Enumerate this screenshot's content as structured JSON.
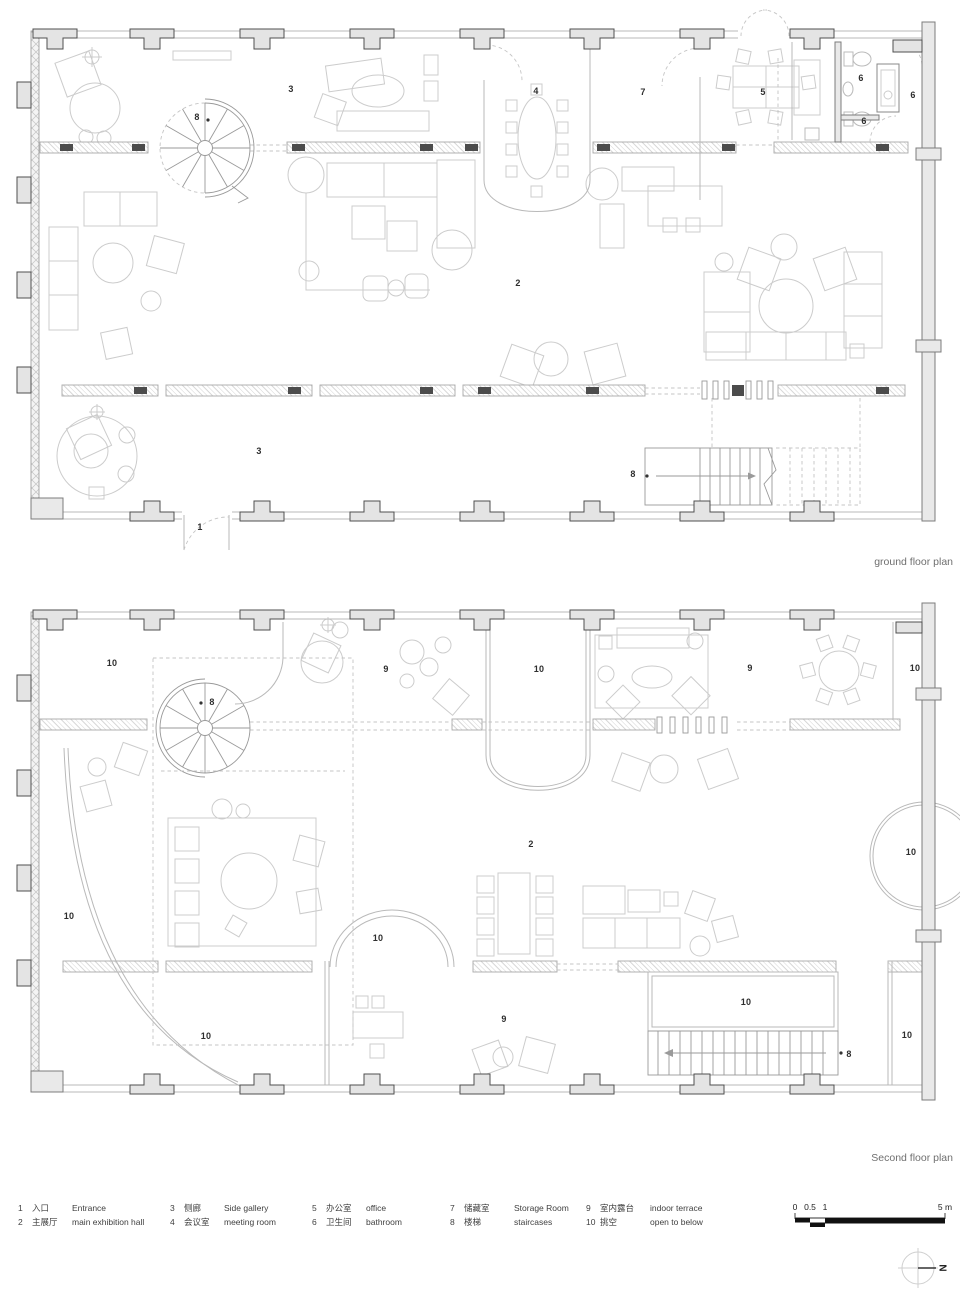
{
  "titles": {
    "ground": "ground floor plan",
    "second": "Second floor plan"
  },
  "north": {
    "label": "N"
  },
  "scalebar": {
    "unit_note": "meters",
    "ticks": [
      {
        "t": "0",
        "x": 795
      },
      {
        "t": "0.5",
        "x": 810
      },
      {
        "t": "1",
        "x": 825
      },
      {
        "t": "5 m",
        "x": 945
      }
    ]
  },
  "legend": {
    "columns": [
      [
        {
          "n": "1",
          "zh": "入口",
          "en": "Entrance"
        },
        {
          "n": "2",
          "zh": "主展厅",
          "en": "main exhibition hall"
        }
      ],
      [
        {
          "n": "3",
          "zh": "侧廊",
          "en": "Side gallery"
        },
        {
          "n": "4",
          "zh": "会议室",
          "en": "meeting room"
        }
      ],
      [
        {
          "n": "5",
          "zh": "办公室",
          "en": "office"
        },
        {
          "n": "6",
          "zh": "卫生间",
          "en": "bathroom"
        }
      ],
      [
        {
          "n": "7",
          "zh": "储藏室",
          "en": "Storage Room"
        },
        {
          "n": "8",
          "zh": "楼梯",
          "en": "staircases"
        }
      ],
      [
        {
          "n": "9",
          "zh": "室内露台",
          "en": "indoor terrace"
        },
        {
          "n": "10",
          "zh": "挑空",
          "en": "open to below"
        }
      ]
    ]
  },
  "ground": {
    "labels": [
      {
        "t": "3",
        "x": 291,
        "y": 89
      },
      {
        "t": "8",
        "x": 197,
        "y": 117
      },
      {
        "t": "4",
        "x": 536,
        "y": 91
      },
      {
        "t": "7",
        "x": 643,
        "y": 92
      },
      {
        "t": "5",
        "x": 763,
        "y": 92
      },
      {
        "t": "6",
        "x": 861,
        "y": 78
      },
      {
        "t": "6",
        "x": 913,
        "y": 95
      },
      {
        "t": "6",
        "x": 864,
        "y": 121
      },
      {
        "t": "2",
        "x": 518,
        "y": 283
      },
      {
        "t": "3",
        "x": 259,
        "y": 451
      },
      {
        "t": "1",
        "x": 200,
        "y": 527
      },
      {
        "t": "8",
        "x": 633,
        "y": 474
      }
    ]
  },
  "second": {
    "labels": [
      {
        "t": "10",
        "x": 112,
        "y": 663
      },
      {
        "t": "8",
        "x": 212,
        "y": 702
      },
      {
        "t": "9",
        "x": 386,
        "y": 669
      },
      {
        "t": "10",
        "x": 539,
        "y": 669
      },
      {
        "t": "9",
        "x": 750,
        "y": 668
      },
      {
        "t": "10",
        "x": 915,
        "y": 668
      },
      {
        "t": "2",
        "x": 531,
        "y": 844
      },
      {
        "t": "10",
        "x": 911,
        "y": 852
      },
      {
        "t": "10",
        "x": 69,
        "y": 916
      },
      {
        "t": "10",
        "x": 378,
        "y": 938
      },
      {
        "t": "10",
        "x": 206,
        "y": 1036
      },
      {
        "t": "9",
        "x": 504,
        "y": 1019
      },
      {
        "t": "10",
        "x": 746,
        "y": 1002
      },
      {
        "t": "8",
        "x": 849,
        "y": 1054
      },
      {
        "t": "10",
        "x": 907,
        "y": 1035
      }
    ]
  }
}
